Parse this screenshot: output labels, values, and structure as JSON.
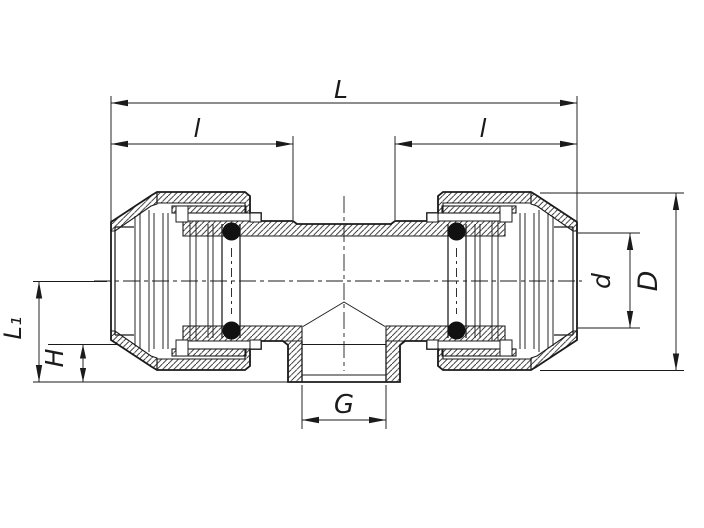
{
  "canvas": {
    "width": 704,
    "height": 528,
    "background": "#ffffff",
    "ink": "#1b1b1b"
  },
  "drawing": {
    "kind": "sectional engineering drawing of a compression tee pipe fitting",
    "style": "black line art with 45-degree section hatching, dash-dot centerlines, o-ring seals shown as filled circles"
  },
  "dimension_labels": {
    "overall_length": "L",
    "left_engagement": "l",
    "right_engagement": "l",
    "branch_thread": "G",
    "bore_diameter": "d",
    "outside_diameter": "D",
    "center_to_branch": "L₁",
    "branch_offset": "H"
  }
}
